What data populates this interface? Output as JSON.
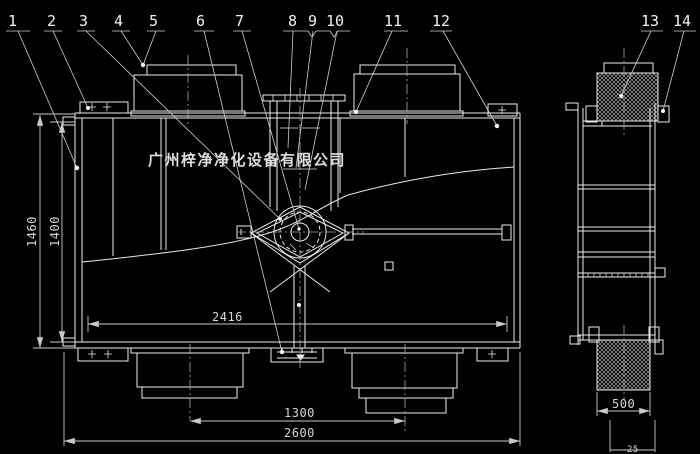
{
  "meta": {
    "background_color": "#000000",
    "line_color": "#ebebeb",
    "dim_color": "#c9c9c9",
    "description": "CAD assembly drawing, front view and side view of air purification unit"
  },
  "watermark": {
    "company": "广州梓净净化设备有限公司"
  },
  "callouts": {
    "c1": "1",
    "c2": "2",
    "c3": "3",
    "c4": "4",
    "c5": "5",
    "c6": "6",
    "c7": "7",
    "c8": "8",
    "c9": "9",
    "c10": "10",
    "c11": "11",
    "c12": "12",
    "c13": "13",
    "c14": "14"
  },
  "dimensions": {
    "overall_height": "1460",
    "inner_height": "1400",
    "inner_width": "2416",
    "duct_centers": "1300",
    "overall_width": "2600",
    "filter_width": "500",
    "clipped_bottom": "25"
  }
}
